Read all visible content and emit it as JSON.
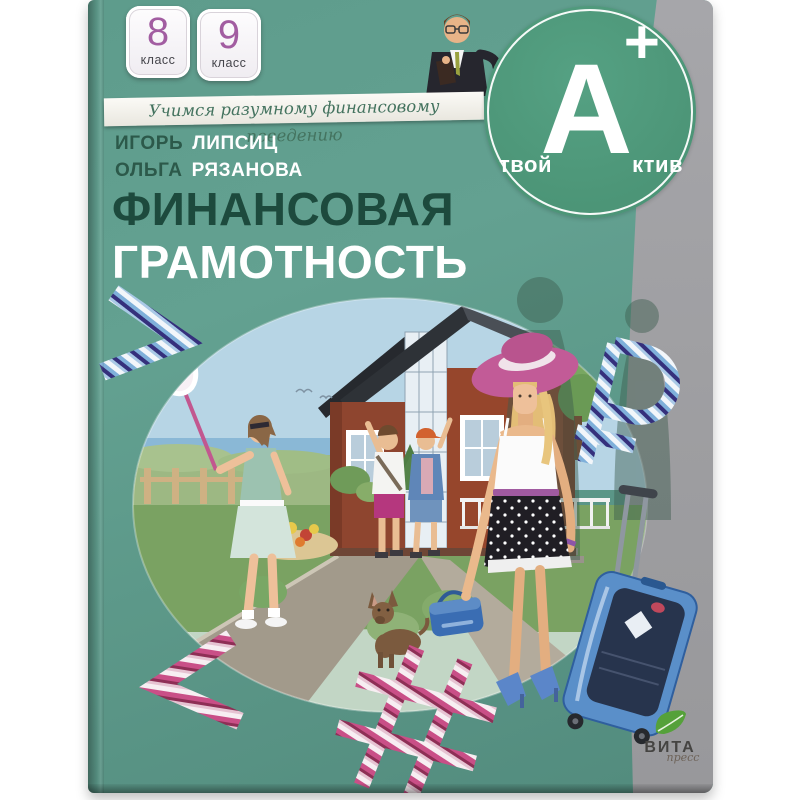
{
  "page": {
    "background_color": "#ffffff"
  },
  "cover": {
    "grade_badges": [
      {
        "number": "8",
        "label": "класс"
      },
      {
        "number": "9",
        "label": "класс"
      }
    ],
    "ribbon_text": "Учимся разумному финансовому поведению",
    "brand_logo": {
      "prefix": "твой",
      "letter": "А",
      "plus": "+",
      "suffix": "ктив"
    },
    "authors": [
      {
        "first_name": "ИГОРЬ",
        "last_name": "ЛИПСИЦ"
      },
      {
        "first_name": "ОЛЬГА",
        "last_name": "РЯЗАНОВА"
      }
    ],
    "title_line1": "ФИНАНСОВАЯ",
    "title_line2": "ГРАМОТНОСТЬ",
    "decorative_symbols": {
      "chevron_top_left": ">",
      "ruble_sign": "₽",
      "chevron_bottom_left": "<",
      "hashtag": "#"
    },
    "publisher": {
      "name": "ВИТА",
      "script": "пресс"
    }
  },
  "colors": {
    "page_bg": "#ffffff",
    "cover_green": "#5e9c8c",
    "cover_green_deep": "#528b7d",
    "gray_band": "#9d9da0",
    "logo_circle_green": "#4c9577",
    "title_dark_green": "#1d4a3d",
    "author_first_green": "#2c594a",
    "badge_number_purple": "#a25da1",
    "ribbon_text_green": "#44735f",
    "hat_pink": "#c25b97",
    "suitcase_blue": "#5a8fc9",
    "stripe_blue": "#7fb0da",
    "stripe_violet": "#35307c",
    "stripe_pink": "#c94f87",
    "house_brick": "#96462c",
    "sky_blue": "#b7d5e5",
    "publisher_leaf_green": "#55a13a"
  }
}
